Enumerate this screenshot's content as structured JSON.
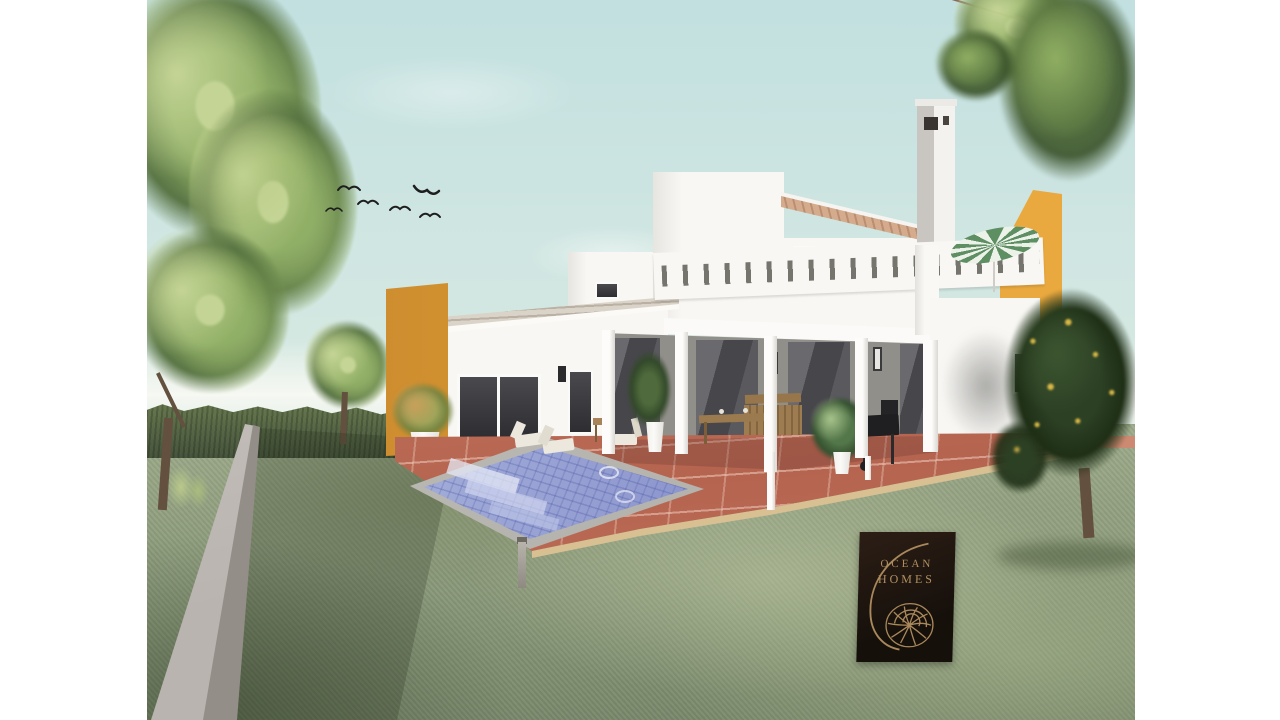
{
  "meta": {
    "kind": "architectural-exterior-rendering",
    "subject": "modern two-storey white villa with orange accent walls, covered porch, roof terrace, swimming pool and landscaped garden",
    "canvas": {
      "width": 1280,
      "height": 720,
      "margin_color": "#ffffff"
    }
  },
  "branding": {
    "line1": "OCEAN",
    "line2": "HOMES",
    "emblem": "nautilus-shell-spiral",
    "plate_color": "#1f150e",
    "text_color": "#b18f60"
  },
  "scene": {
    "birds_in_sky": 6,
    "sky": "pale turquoise, clear",
    "garden": [
      "sloping lawn",
      "clipped hedge",
      "low concrete boundary wall",
      "deciduous tree",
      "citrus tree with yellow fruit",
      "overhanging maple branch"
    ],
    "house": [
      "white stucco volumes",
      "orange entrance pylon",
      "tall orange feature wall",
      "white chimney with vents",
      "slotted roof-terrace parapet",
      "tiled roof strips",
      "green canvas parasol on terrace"
    ],
    "terrace": [
      "terracotta tiled patio",
      "blue mosaic swimming pool with stone coping",
      "timber deck edge",
      "bollard light"
    ],
    "furniture": [
      "sun loungers",
      "side table",
      "outdoor dining table",
      "slatted bench",
      "potted plants",
      "barbecue grill",
      "wall lanterns"
    ]
  },
  "palette": {
    "sky-top": "#c2e0e0",
    "sky-mid": "#d5e8e2",
    "sky-low": "#eaf1e8",
    "haze": "#f6f8f2",
    "hedge-hi": "#67794f",
    "hedge-lo": "#46543c",
    "grass-hi": "#9dab8a",
    "grass-lo": "#78876a",
    "wall-hi": "#d2cdca",
    "wall-lo": "#948e88",
    "white-hi": "#f8f7f4",
    "white-lo": "#e7e5e0",
    "porch-wall": "#918f8a",
    "glass-dark": "#48484c",
    "patio-hi": "#d18d74",
    "patio-lo": "#b5644f",
    "grout": "#f0cdbe",
    "coping-hi": "#c8c6c0",
    "coping-lo": "#a9a7a1",
    "water-far": "#b3bde0",
    "water-near": "#7a84c2",
    "orange-hi": "#eaa93f",
    "orange-lo": "#c9882d",
    "roof-light": "#dad3c8",
    "roof-warm": "#d4ab8d",
    "wood": "#9a7a4e",
    "wood-dark": "#7c5f3a",
    "cream": "#ece8dd",
    "wood-trim": "#d8c092",
    "parasol-green": "#5d8f63",
    "parasol-white": "#edf2e8",
    "leaf-light": "#c4d492",
    "leaf-mid": "#8fae62",
    "leaf-dark": "#55713f",
    "citrus-dark": "#2c4024",
    "citrus-deep": "#1e2f16",
    "fruit": "#d9b845",
    "trunk": "#63503e",
    "bird": "#1e1e1e",
    "plate-hi": "#2c1e15",
    "plate-lo": "#16100b",
    "gold": "#b18f60"
  }
}
